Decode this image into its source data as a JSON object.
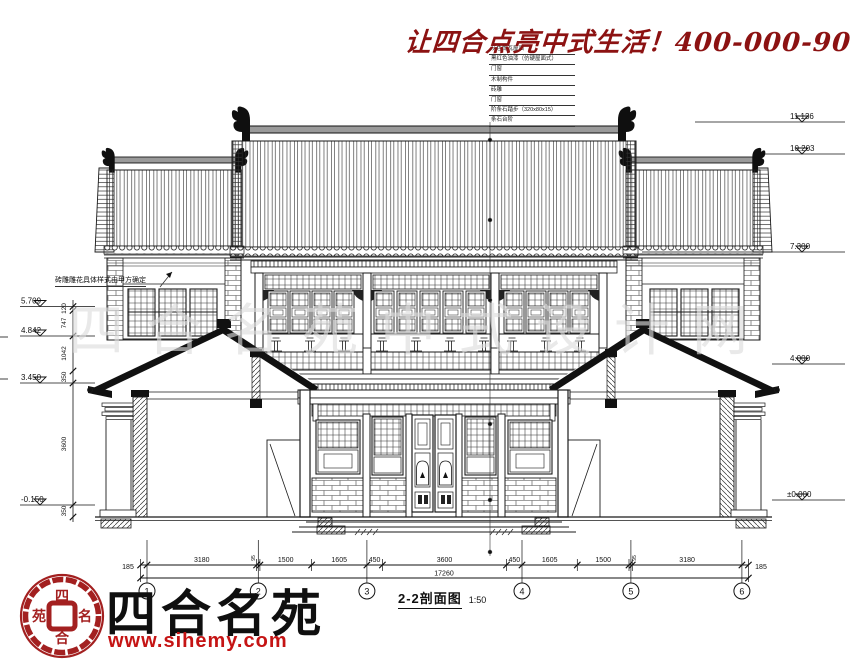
{
  "slogan": {
    "text": "让四合点亮中式生活！",
    "phone": "400-000-9075"
  },
  "watermark": "四合名苑中式设计网",
  "annotations": {
    "left_note": "砖雕雕花具体样式由甲方确定",
    "roof_stack": [
      "灰色筒瓦屋面",
      "黑红色油漆（仿硬屋面式）",
      "门窗",
      "木制构件",
      "砖雕",
      "门窗",
      "阶条石踏步（320x80x15）",
      "条石台阶"
    ]
  },
  "levels": {
    "left": [
      "5.709",
      "4.842",
      "3.450",
      "-0.150"
    ],
    "right": [
      "11.136",
      "10.203",
      "7.300",
      "4.000",
      "±0.000"
    ],
    "chain": [
      "120",
      "747",
      "1042",
      "350",
      "3600",
      "350"
    ]
  },
  "dims": {
    "ends": [
      "185",
      "185"
    ],
    "segments": [
      "3180",
      "95",
      "1500",
      "1605",
      "450",
      "3600",
      "450",
      "1605",
      "1500",
      "95",
      "3180"
    ],
    "total": "17260"
  },
  "grid": [
    "1",
    "2",
    "3",
    "4",
    "5",
    "6"
  ],
  "titleblock": {
    "title": "2-2剖面图",
    "scale": "1:50"
  },
  "brand": {
    "name": "四合名苑",
    "website": "www.sihemy.com",
    "seal": [
      "四",
      "名",
      "合",
      "苑"
    ]
  }
}
